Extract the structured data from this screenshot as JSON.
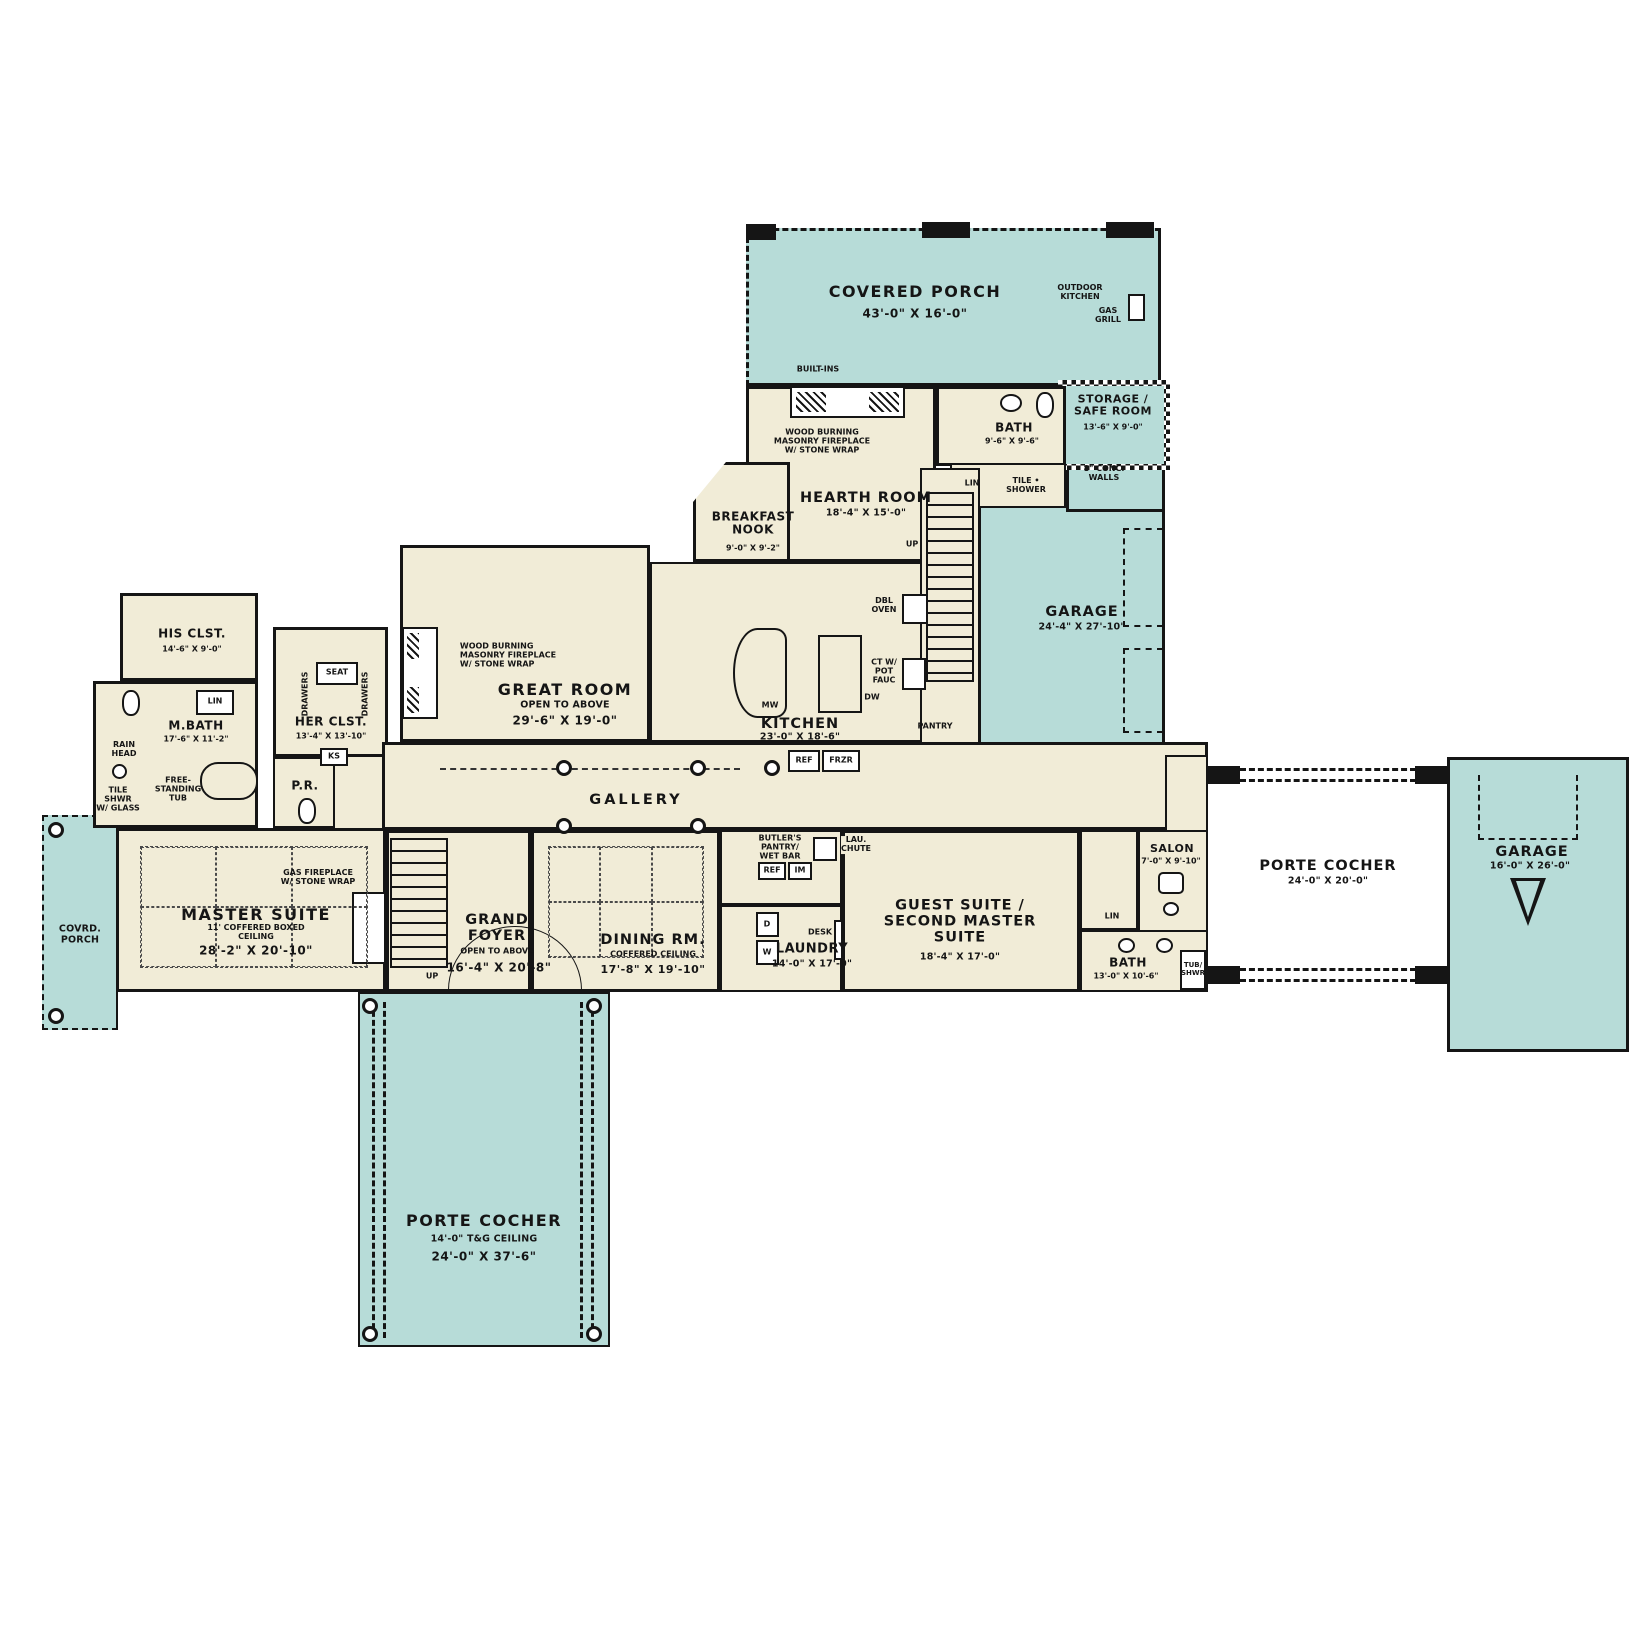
{
  "plan_title": "First Floor Plan",
  "colors": {
    "porch_fill": "#b7dcd8",
    "interior_fill": "#f1ecd7",
    "wall": "#151515"
  },
  "rooms": {
    "covered_porch": {
      "name": "COVERED PORCH",
      "dims": "43'-0\" X 16'-0\""
    },
    "storage": {
      "name": "STORAGE /\nSAFE ROOM",
      "dims": "13'-6\" X 9'-0\""
    },
    "bath_top": {
      "name": "BATH",
      "dims": "9'-6\" X 9'-6\""
    },
    "hearth": {
      "name": "HEARTH ROOM",
      "dims": "18'-4\" X 15'-0\""
    },
    "breakfast": {
      "name": "BREAKFAST\nNOOK",
      "dims": "9'-0\" X 9'-2\""
    },
    "garage_main": {
      "name": "GARAGE",
      "dims": "24'-4\" X 27'-10\""
    },
    "great_room": {
      "name": "GREAT ROOM",
      "sub": "OPEN TO ABOVE",
      "dims": "29'-6\" X 19'-0\""
    },
    "kitchen": {
      "name": "KITCHEN",
      "dims": "23'-0\" X 18'-6\""
    },
    "his_closet": {
      "name": "HIS CLST.",
      "dims": "14'-6\" X 9'-0\""
    },
    "her_closet": {
      "name": "HER CLST.",
      "dims": "13'-4\" X 13'-10\""
    },
    "master_bath": {
      "name": "M.BATH",
      "dims": "17'-6\" X 11'-2\""
    },
    "powder_room": {
      "name": "P.R."
    },
    "gallery": {
      "name": "GALLERY"
    },
    "master_suite": {
      "name": "MASTER SUITE",
      "sub": "11' COFFERED BOXED\nCEILING",
      "dims": "28'-2\" X 20'-10\""
    },
    "covered_porch_left": {
      "name": "COVRD.\nPORCH"
    },
    "grand_foyer": {
      "name": "GRAND\nFOYER",
      "sub": "OPEN TO ABOVE",
      "dims": "16'-4\" X 20'-8\""
    },
    "dining": {
      "name": "DINING RM.",
      "sub": "COFFERED CEILING",
      "dims": "17'-8\" X 19'-10\""
    },
    "butlers_pantry": {
      "name": "BUTLER'S\nPANTRY/\nWET BAR"
    },
    "laundry": {
      "name": "LAUNDRY",
      "dims": "14'-0\" X 17'-0\""
    },
    "guest_suite": {
      "name": "GUEST SUITE /\nSECOND MASTER\nSUITE",
      "dims": "18'-4\" X 17'-0\""
    },
    "salon": {
      "name": "SALON",
      "dims": "7'-0\" X 9'-10\""
    },
    "bath_guest": {
      "name": "BATH",
      "dims": "13'-0\" X 10'-6\""
    },
    "porte_cocher_right": {
      "name": "PORTE COCHER",
      "dims": "24'-0\" X 20'-0\""
    },
    "garage_right": {
      "name": "GARAGE",
      "dims": "16'-0\" X 26'-0\""
    },
    "porte_cocher_bottom": {
      "name": "PORTE COCHER",
      "sub": "14'-0\" T&G CEILING",
      "dims": "24'-0\" X 37'-6\""
    }
  },
  "annotations": {
    "outdoor_kitchen": "OUTDOOR\nKITCHEN",
    "gas_grill": "GAS\nGRILL",
    "built_ins": "BUILT-INS",
    "wood_fireplace": "WOOD BURNING\nMASONRY FIREPLACE\nW/ STONE WRAP",
    "gas_fireplace": "GAS FIREPLACE\nW/ STONE WRAP",
    "conc_walls": "8\" CONC.\nWALLS",
    "tile_shower": "TILE •\nSHOWER",
    "lin": "LIN",
    "up": "UP",
    "dbl_oven": "DBL\nOVEN",
    "ct_pot_fauc": "CT W/\nPOT\nFAUC",
    "mw": "MW",
    "dw": "DW",
    "pantry": "PANTRY",
    "ref": "REF",
    "frzr": "FRZR",
    "im": "IM",
    "lau_chute": "LAU.\nCHUTE",
    "dryer": "D",
    "washer": "W",
    "desk": "DESK",
    "seat": "SEAT",
    "drawers": "DRAWERS",
    "ks": "KS",
    "rain_head": "RAIN\nHEAD",
    "tile_shwr_glass": "TILE\nSHWR\nW/ GLASS",
    "freestanding_tub": "FREE-\nSTANDING\nTUB",
    "tub_shwr": "TUB/\nSHWR"
  }
}
